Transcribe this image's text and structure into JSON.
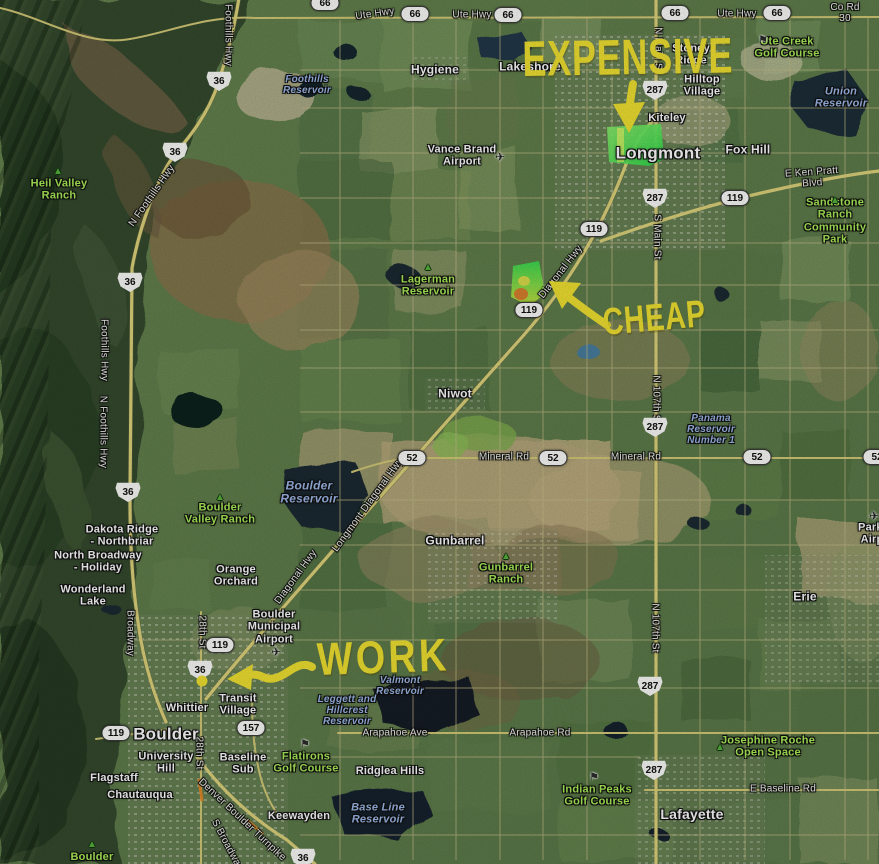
{
  "annotations": {
    "color": "#f2e332",
    "expensive": {
      "text": "EXPENSIVE"
    },
    "cheap": {
      "text": "CHEAP"
    },
    "work": {
      "text": "WORK"
    }
  },
  "map": {
    "road_labels": [
      {
        "text": "Foothills Hwy",
        "x": 228,
        "y": 35,
        "r": 90
      },
      {
        "text": "Ute Hwy",
        "x": 375,
        "y": 14,
        "r": -8
      },
      {
        "text": "Ute Hwy",
        "x": 472,
        "y": 15
      },
      {
        "text": "Ute Hwy",
        "x": 737,
        "y": 14
      },
      {
        "text": "Co Rd 30",
        "x": 845,
        "y": 13
      },
      {
        "text": "E Ken Pratt Blvd",
        "x": 812,
        "y": 178,
        "r": -4
      },
      {
        "text": "N Foothills Hwy",
        "x": 152,
        "y": 196,
        "r": -55
      },
      {
        "text": "Foothills Hwy",
        "x": 104,
        "y": 350,
        "r": 90
      },
      {
        "text": "N Foothills Hwy",
        "x": 103,
        "y": 432,
        "r": 90
      },
      {
        "text": "Diagonal Hwy",
        "x": 561,
        "y": 272,
        "r": -52
      },
      {
        "text": "Mineral Rd",
        "x": 504,
        "y": 457
      },
      {
        "text": "Mineral Rd",
        "x": 636,
        "y": 457
      },
      {
        "text": "Longmont Diagonal Hwy",
        "x": 368,
        "y": 505,
        "r": -54
      },
      {
        "text": "Diagonal Hwy",
        "x": 296,
        "y": 577,
        "r": -54
      },
      {
        "text": "Broadway",
        "x": 130,
        "y": 633,
        "r": 90
      },
      {
        "text": "28th St",
        "x": 202,
        "y": 632,
        "r": 90
      },
      {
        "text": "28th St",
        "x": 199,
        "y": 753,
        "r": 90
      },
      {
        "text": "N Main St",
        "x": 658,
        "y": 50,
        "r": 90
      },
      {
        "text": "S Main St",
        "x": 657,
        "y": 237,
        "r": 90
      },
      {
        "text": "N 107th St",
        "x": 656,
        "y": 400,
        "r": 90
      },
      {
        "text": "N 107th St",
        "x": 655,
        "y": 628,
        "r": 90
      },
      {
        "text": "Arapahoe Ave",
        "x": 395,
        "y": 733
      },
      {
        "text": "Arapahoe Rd",
        "x": 540,
        "y": 733
      },
      {
        "text": "E Baseline Rd",
        "x": 783,
        "y": 789
      },
      {
        "text": "Denver Boulder Turnpike",
        "x": 242,
        "y": 820,
        "r": 43
      },
      {
        "text": "S Broadway",
        "x": 227,
        "y": 845,
        "r": 62
      }
    ],
    "place_labels": [
      {
        "text": "Hygiene",
        "x": 435,
        "y": 70,
        "s": 12
      },
      {
        "text": "Lakeshore",
        "x": 530,
        "y": 67,
        "s": 12
      },
      {
        "text": "Stoney\nRidge",
        "x": 691,
        "y": 55,
        "s": 11
      },
      {
        "text": "Hilltop\nVillage",
        "x": 702,
        "y": 86,
        "s": 11
      },
      {
        "text": "Kiteley",
        "x": 667,
        "y": 118,
        "s": 11
      },
      {
        "text": "Fox Hill",
        "x": 748,
        "y": 150,
        "s": 12
      },
      {
        "text": "Longmont",
        "x": 658,
        "y": 153,
        "s": 17
      },
      {
        "text": "Vance Brand\nAirport",
        "x": 462,
        "y": 156,
        "s": 11
      },
      {
        "text": "Niwot",
        "x": 455,
        "y": 394,
        "s": 12
      },
      {
        "text": "Gunbarrel",
        "x": 455,
        "y": 541,
        "s": 12
      },
      {
        "text": "Erie",
        "x": 805,
        "y": 597,
        "s": 12
      },
      {
        "text": "Dakota Ridge\n- Northbriar",
        "x": 122,
        "y": 536,
        "s": 11
      },
      {
        "text": "North Broadway\n- Holiday",
        "x": 98,
        "y": 562,
        "s": 11
      },
      {
        "text": "Wonderland\nLake",
        "x": 93,
        "y": 596,
        "s": 11
      },
      {
        "text": "Orange\nOrchard",
        "x": 236,
        "y": 576,
        "s": 11
      },
      {
        "text": "Boulder\nMunicipal\nAirport",
        "x": 274,
        "y": 627,
        "s": 11
      },
      {
        "text": "Transit\nVillage",
        "x": 238,
        "y": 705,
        "s": 11
      },
      {
        "text": "Whittier",
        "x": 187,
        "y": 708,
        "s": 11
      },
      {
        "text": "Boulder",
        "x": 166,
        "y": 734,
        "s": 17
      },
      {
        "text": "University\nHill",
        "x": 166,
        "y": 763,
        "s": 11
      },
      {
        "text": "Baseline\nSub",
        "x": 243,
        "y": 764,
        "s": 11
      },
      {
        "text": "Flagstaff",
        "x": 114,
        "y": 778,
        "s": 11
      },
      {
        "text": "Chautauqua",
        "x": 140,
        "y": 795,
        "s": 11
      },
      {
        "text": "Keewayden",
        "x": 299,
        "y": 816,
        "s": 11
      },
      {
        "text": "Ridglea Hills",
        "x": 390,
        "y": 771,
        "s": 11
      },
      {
        "text": "Lafayette",
        "x": 692,
        "y": 815,
        "s": 14
      },
      {
        "text": "Parkl\nAirp",
        "x": 872,
        "y": 534,
        "s": 11
      }
    ],
    "water_labels": [
      {
        "text": "Foothills\nReservoir",
        "x": 307,
        "y": 85,
        "s": 10
      },
      {
        "text": "Union\nReservoir",
        "x": 841,
        "y": 98,
        "s": 11
      },
      {
        "text": "Boulder\nReservoir",
        "x": 309,
        "y": 493,
        "s": 12
      },
      {
        "text": "Panama\nReservoir\nNumber 1",
        "x": 711,
        "y": 430,
        "s": 10
      },
      {
        "text": "Valmont\nReservoir",
        "x": 400,
        "y": 686,
        "s": 10
      },
      {
        "text": "Leggett and\nHillcrest\nReservoir",
        "x": 347,
        "y": 711,
        "s": 10
      },
      {
        "text": "Base Line\nReservoir",
        "x": 378,
        "y": 814,
        "s": 11
      }
    ],
    "park_labels": [
      {
        "text": "Heil Valley\nRanch",
        "x": 59,
        "y": 190,
        "s": 11
      },
      {
        "text": "Ute Creek\nGolf Course",
        "x": 787,
        "y": 48,
        "s": 11
      },
      {
        "text": "Sandstone Ranch\nCommunity Park",
        "x": 835,
        "y": 221,
        "s": 11
      },
      {
        "text": "Lagerman\nReservoir",
        "x": 428,
        "y": 286,
        "s": 11
      },
      {
        "text": "Boulder\nValley Ranch",
        "x": 220,
        "y": 514,
        "s": 11
      },
      {
        "text": "Gunbarrel\nRanch",
        "x": 506,
        "y": 574,
        "s": 11
      },
      {
        "text": "Flatirons\nGolf Course",
        "x": 306,
        "y": 763,
        "s": 11
      },
      {
        "text": "Indian Peaks\nGolf Course",
        "x": 597,
        "y": 796,
        "s": 11
      },
      {
        "text": "Josephine Roche\nOpen Space",
        "x": 768,
        "y": 747,
        "s": 11
      },
      {
        "text": "Boulder",
        "x": 92,
        "y": 857,
        "s": 11
      }
    ],
    "shields": [
      {
        "route": "36",
        "type": "us",
        "x": 219,
        "y": 81
      },
      {
        "route": "36",
        "type": "us",
        "x": 175,
        "y": 152
      },
      {
        "route": "36",
        "type": "us",
        "x": 130,
        "y": 282
      },
      {
        "route": "36",
        "type": "us",
        "x": 128,
        "y": 492
      },
      {
        "route": "36",
        "type": "us",
        "x": 200,
        "y": 670
      },
      {
        "route": "36",
        "type": "us",
        "x": 303,
        "y": 858
      },
      {
        "route": "287",
        "type": "us",
        "x": 655,
        "y": 90
      },
      {
        "route": "287",
        "type": "us",
        "x": 655,
        "y": 198
      },
      {
        "route": "287",
        "type": "us",
        "x": 655,
        "y": 427
      },
      {
        "route": "287",
        "type": "us",
        "x": 650,
        "y": 686
      },
      {
        "route": "287",
        "type": "us",
        "x": 654,
        "y": 770
      },
      {
        "route": "66",
        "type": "st",
        "x": 325,
        "y": 3
      },
      {
        "route": "66",
        "type": "st",
        "x": 415,
        "y": 14
      },
      {
        "route": "66",
        "type": "st",
        "x": 508,
        "y": 15
      },
      {
        "route": "66",
        "type": "st",
        "x": 675,
        "y": 13
      },
      {
        "route": "66",
        "type": "st",
        "x": 777,
        "y": 13
      },
      {
        "route": "119",
        "type": "st",
        "x": 594,
        "y": 229
      },
      {
        "route": "119",
        "type": "st",
        "x": 735,
        "y": 198
      },
      {
        "route": "119",
        "type": "st",
        "x": 529,
        "y": 310
      },
      {
        "route": "119",
        "type": "st",
        "x": 220,
        "y": 645
      },
      {
        "route": "119",
        "type": "st",
        "x": 116,
        "y": 733
      },
      {
        "route": "52",
        "type": "st",
        "x": 412,
        "y": 458
      },
      {
        "route": "52",
        "type": "st",
        "x": 553,
        "y": 458
      },
      {
        "route": "52",
        "type": "st",
        "x": 757,
        "y": 457
      },
      {
        "route": "52",
        "type": "st",
        "x": 877,
        "y": 457
      },
      {
        "route": "157",
        "type": "st",
        "x": 251,
        "y": 728
      }
    ],
    "icons": [
      {
        "glyph": "plane",
        "x": 500,
        "y": 157
      },
      {
        "glyph": "plane",
        "x": 276,
        "y": 652
      },
      {
        "glyph": "plane",
        "x": 874,
        "y": 516
      },
      {
        "glyph": "tree",
        "x": 58,
        "y": 172
      },
      {
        "glyph": "tree",
        "x": 428,
        "y": 268
      },
      {
        "glyph": "tree",
        "x": 220,
        "y": 498
      },
      {
        "glyph": "tree",
        "x": 506,
        "y": 557
      },
      {
        "glyph": "tree",
        "x": 720,
        "y": 748
      },
      {
        "glyph": "tree",
        "x": 92,
        "y": 845
      },
      {
        "glyph": "tree",
        "x": 835,
        "y": 201
      },
      {
        "glyph": "golf",
        "x": 305,
        "y": 745
      },
      {
        "glyph": "golf",
        "x": 594,
        "y": 778
      },
      {
        "glyph": "golf",
        "x": 763,
        "y": 41
      }
    ]
  }
}
